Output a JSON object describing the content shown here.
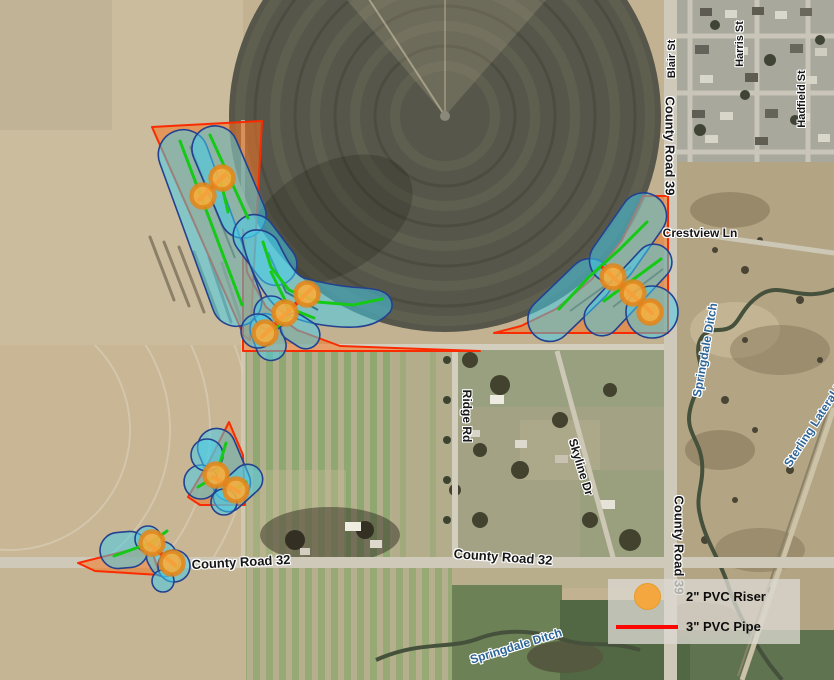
{
  "legend": {
    "items": [
      {
        "id": "riser",
        "symbol": "orange-circle",
        "label": "2\" PVC Riser",
        "color": "#f3a73e"
      },
      {
        "id": "pipe",
        "symbol": "red-line",
        "label": "3\" PVC Pipe",
        "color": "#fe0600"
      }
    ]
  },
  "labels": [
    {
      "id": "blair-st",
      "kind": "road",
      "text": "Blair St",
      "x": 672,
      "y": 59,
      "rot": -90,
      "size": 11
    },
    {
      "id": "harris-st",
      "kind": "road",
      "text": "Harris St",
      "x": 740,
      "y": 44,
      "rot": -90,
      "size": 11
    },
    {
      "id": "hadfield-st",
      "kind": "road",
      "text": "Hadfield St",
      "x": 802,
      "y": 99,
      "rot": -90,
      "size": 11
    },
    {
      "id": "county-road-39-north",
      "kind": "road",
      "text": "County Road 39",
      "x": 670,
      "y": 146,
      "rot": 90,
      "size": 13
    },
    {
      "id": "crestview-ln",
      "kind": "road",
      "text": "Crestview Ln",
      "x": 700,
      "y": 233,
      "rot": 0,
      "size": 12
    },
    {
      "id": "ridge-rd",
      "kind": "road",
      "text": "Ridge Rd",
      "x": 467,
      "y": 416,
      "rot": 90,
      "size": 12
    },
    {
      "id": "skyline-dr",
      "kind": "road",
      "text": "Skyline Dr",
      "x": 581,
      "y": 467,
      "rot": 73,
      "size": 12
    },
    {
      "id": "county-road-39-south",
      "kind": "road",
      "text": "County Road 39",
      "x": 679,
      "y": 545,
      "rot": 90,
      "size": 13
    },
    {
      "id": "county-road-32-west",
      "kind": "road",
      "text": "County Road 32",
      "x": 241,
      "y": 562,
      "rot": -3,
      "size": 13
    },
    {
      "id": "county-road-32-east",
      "kind": "road",
      "text": "County Road 32",
      "x": 503,
      "y": 557,
      "rot": 4,
      "size": 13
    },
    {
      "id": "springdale-ditch-east",
      "kind": "water",
      "text": "Springdale Ditch",
      "x": 705,
      "y": 350,
      "rot": -80,
      "size": 12
    },
    {
      "id": "sterling-lateral",
      "kind": "water",
      "text": "Sterling Lateral N",
      "x": 814,
      "y": 424,
      "rot": -57,
      "size": 12
    },
    {
      "id": "springdale-ditch-south",
      "kind": "water",
      "text": "Springdale Ditch",
      "x": 516,
      "y": 646,
      "rot": -17,
      "size": 12
    }
  ],
  "overlay": {
    "colors": {
      "blob_fill": "rgba(68,206,235,0.52)",
      "blob_stroke": "#24418f",
      "corner_fill": "rgba(246,118,34,0.55)",
      "corner_stroke": "#fb2b01",
      "wheel_line": "#16c916",
      "pipe": "#e8291a",
      "riser_fill": "#f7ad3d",
      "riser_stroke": "#e2861b"
    },
    "risers": [
      {
        "x": 203,
        "y": 196
      },
      {
        "x": 222,
        "y": 178
      },
      {
        "x": 307,
        "y": 294
      },
      {
        "x": 285,
        "y": 313
      },
      {
        "x": 265,
        "y": 333
      },
      {
        "x": 613,
        "y": 277
      },
      {
        "x": 633,
        "y": 293
      },
      {
        "x": 650,
        "y": 312
      },
      {
        "x": 216,
        "y": 475
      },
      {
        "x": 236,
        "y": 490
      },
      {
        "x": 152,
        "y": 543
      },
      {
        "x": 172,
        "y": 563
      }
    ],
    "pipes": [
      {
        "points": [
          [
            199,
            200
          ],
          [
            225,
            175
          ]
        ]
      },
      {
        "points": [
          [
            312,
            288
          ],
          [
            262,
            337
          ]
        ]
      },
      {
        "points": [
          [
            603,
            268
          ],
          [
            652,
            313
          ]
        ]
      },
      {
        "points": [
          [
            213,
            477
          ],
          [
            239,
            492
          ]
        ]
      },
      {
        "points": [
          [
            149,
            544
          ],
          [
            175,
            565
          ]
        ]
      }
    ],
    "wheel_lines": [
      {
        "points": [
          [
            180,
            141
          ],
          [
            242,
            305
          ]
        ]
      },
      {
        "points": [
          [
            210,
            135
          ],
          [
            248,
            218
          ]
        ]
      },
      {
        "points": [
          [
            221,
            182
          ],
          [
            228,
            212
          ]
        ]
      },
      {
        "points": [
          [
            263,
            242
          ],
          [
            271,
            267
          ],
          [
            289,
            290
          ],
          [
            318,
            302
          ],
          [
            353,
            305
          ],
          [
            382,
            299
          ]
        ]
      },
      {
        "points": [
          [
            271,
            272
          ],
          [
            289,
            308
          ],
          [
            314,
            318
          ]
        ]
      },
      {
        "points": [
          [
            272,
            331
          ],
          [
            288,
            318
          ]
        ]
      },
      {
        "points": [
          [
            559,
            309
          ],
          [
            589,
            277
          ],
          [
            620,
            249
          ],
          [
            647,
            222
          ]
        ]
      },
      {
        "points": [
          [
            604,
            301
          ],
          [
            661,
            259
          ]
        ]
      },
      {
        "points": [
          [
            226,
            443
          ],
          [
            217,
            473
          ]
        ]
      },
      {
        "points": [
          [
            214,
            477
          ],
          [
            198,
            487
          ]
        ]
      },
      {
        "points": [
          [
            236,
            489
          ],
          [
            246,
            482
          ]
        ]
      },
      {
        "points": [
          [
            114,
            556
          ],
          [
            150,
            543
          ]
        ]
      },
      {
        "points": [
          [
            152,
            542
          ],
          [
            167,
            531
          ]
        ]
      },
      {
        "points": [
          [
            154,
            546
          ],
          [
            176,
            567
          ]
        ]
      }
    ],
    "imagery_lines": [
      {
        "points": [
          [
            190,
            146
          ],
          [
            235,
            258
          ]
        ]
      },
      {
        "points": [
          [
            268,
            252
          ],
          [
            286,
            292
          ],
          [
            318,
            310
          ]
        ]
      },
      {
        "points": [
          [
            570,
            311
          ],
          [
            631,
            267
          ]
        ]
      },
      {
        "points": [
          [
            613,
            307
          ],
          [
            663,
            269
          ]
        ]
      }
    ]
  }
}
